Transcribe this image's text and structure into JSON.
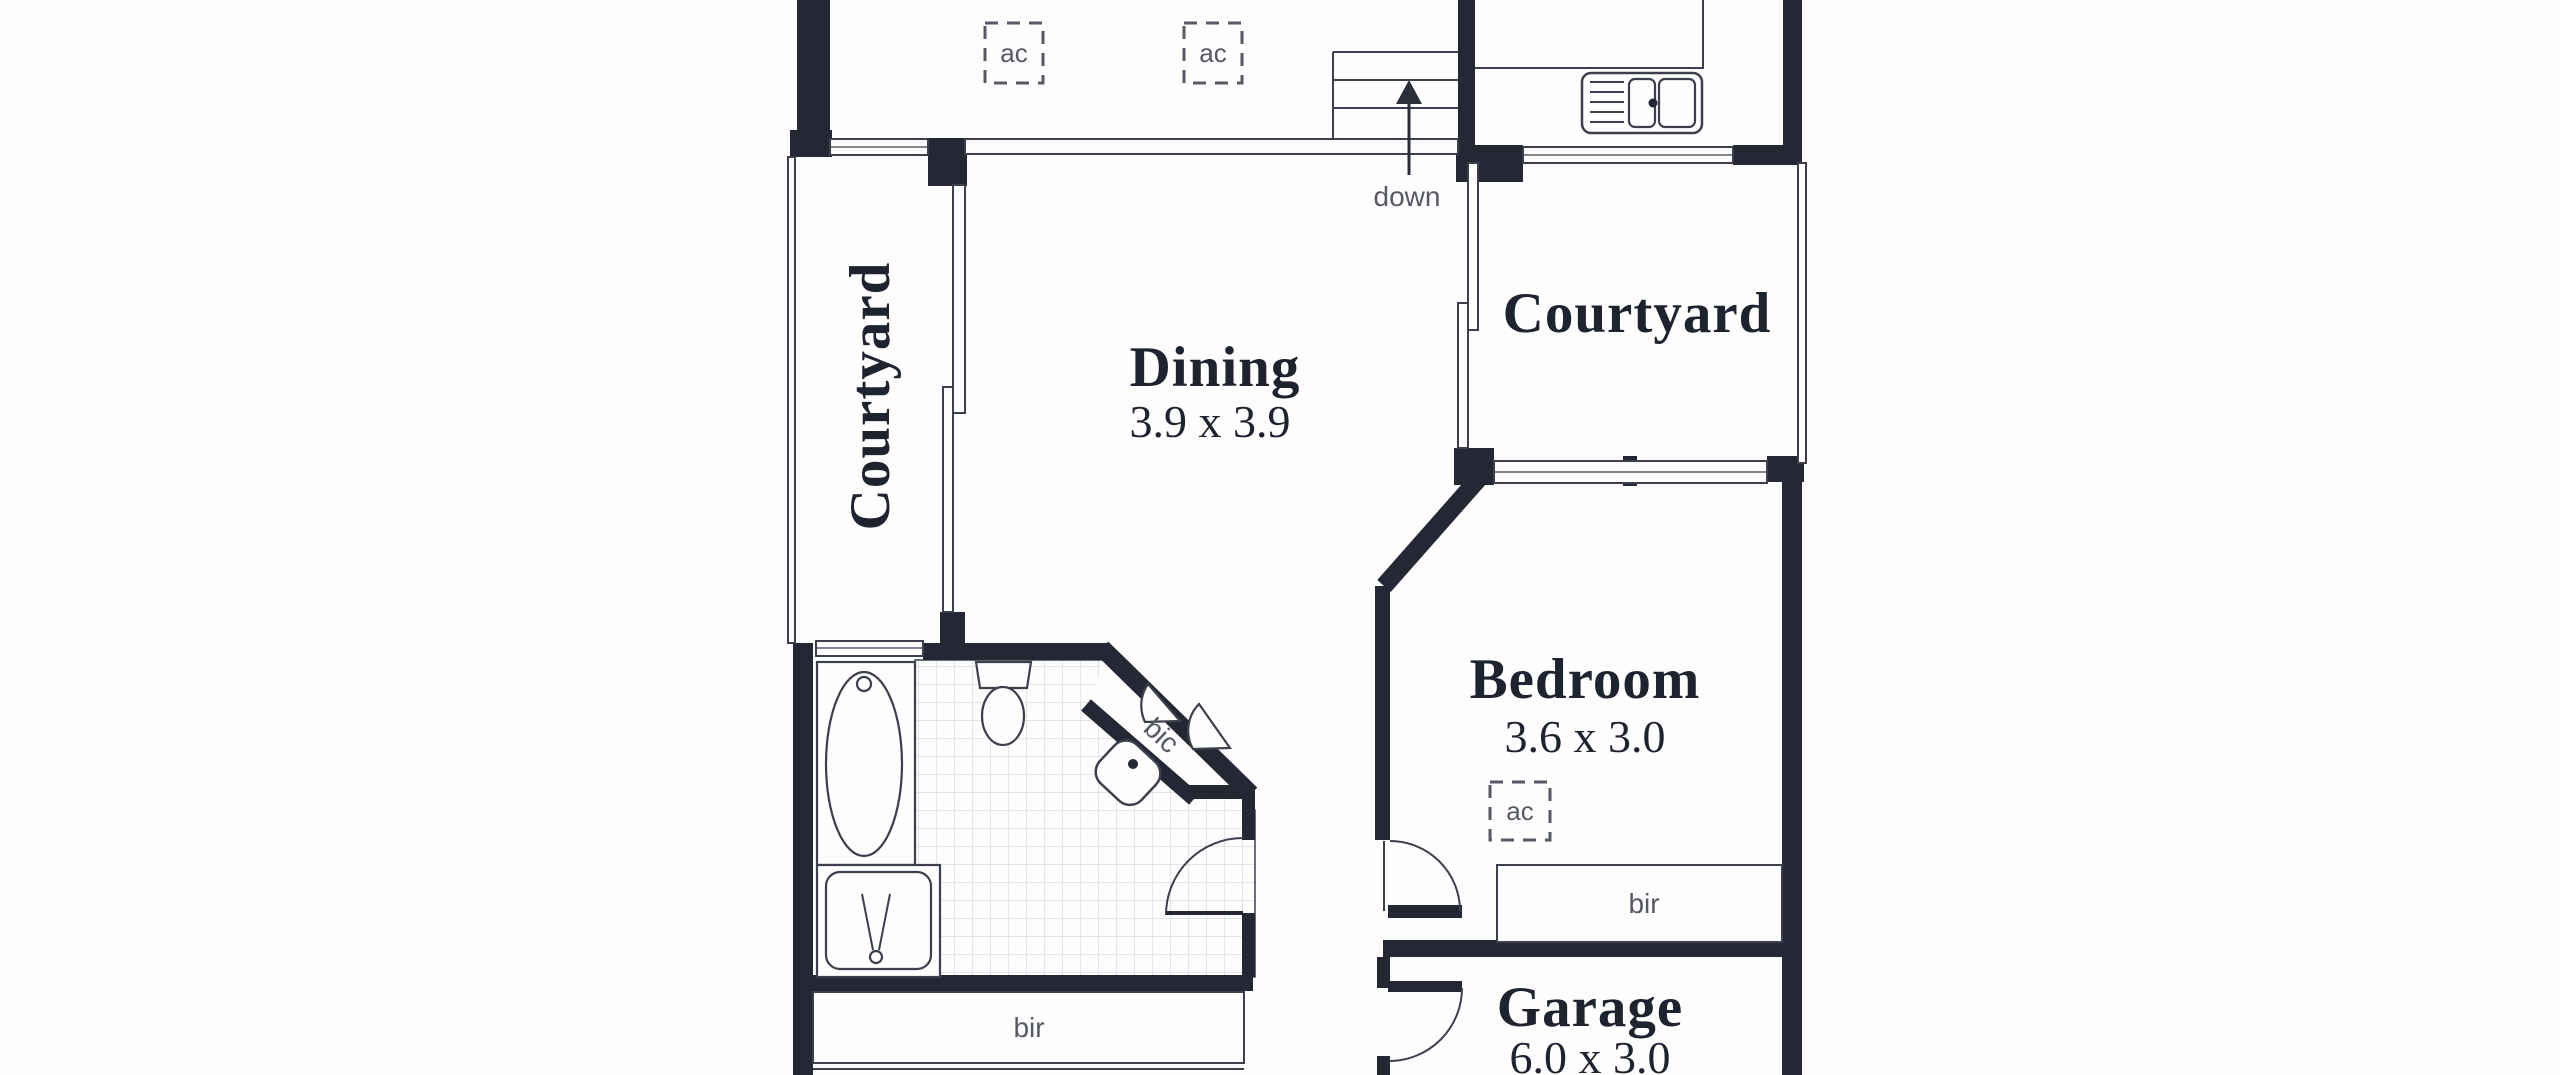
{
  "colors": {
    "wall": "#242834",
    "line": "#3b404c",
    "label": "#1e2330",
    "muted": "#545963",
    "tile": "#c9ccd2",
    "bg": "#fdfdfd"
  },
  "rooms": {
    "courtyard_left": {
      "label": "Courtyard"
    },
    "dining": {
      "label": "Dining",
      "dims": "3.9 x 3.9"
    },
    "courtyard_right": {
      "label": "Courtyard"
    },
    "bedroom": {
      "label": "Bedroom",
      "dims": "3.6 x 3.0"
    },
    "garage": {
      "label": "Garage",
      "dims": "6.0 x 3.0"
    }
  },
  "annotations": {
    "down": "down",
    "ac": "ac",
    "bir": "bir",
    "bic": "bic"
  }
}
